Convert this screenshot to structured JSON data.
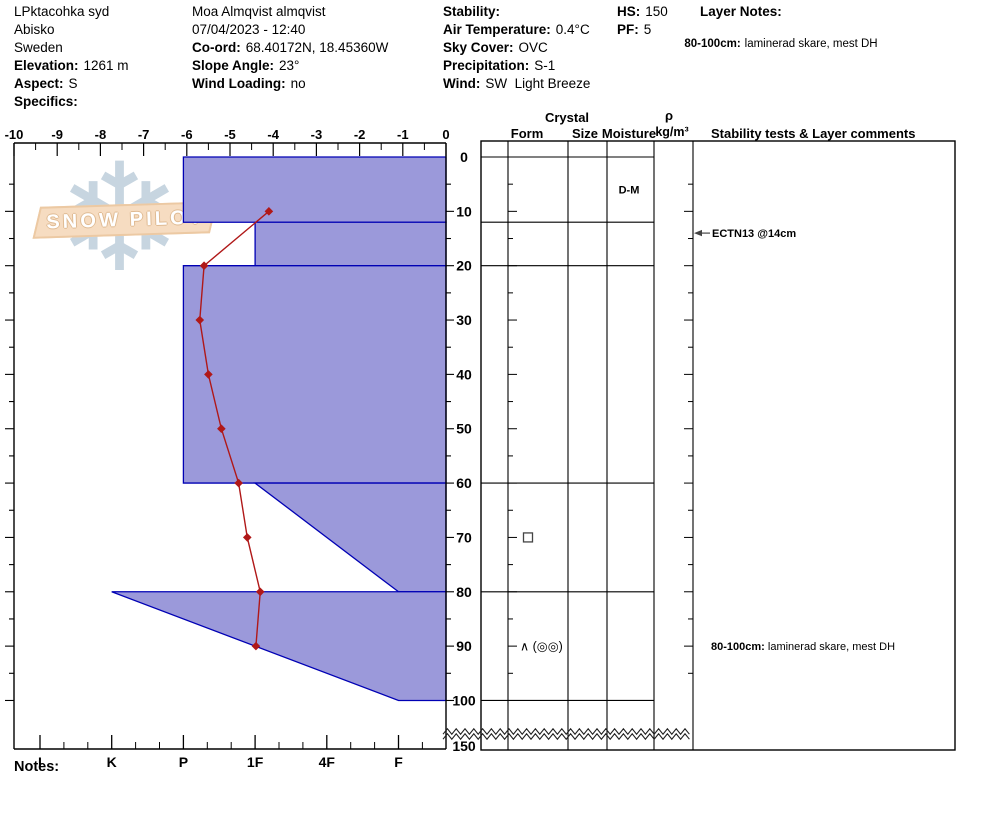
{
  "logo": {
    "text": "SNOW PILOT"
  },
  "notes_label": "Notes:",
  "header": {
    "location": {
      "name": "LPktacohka syd",
      "region": "Abisko",
      "country": "Sweden",
      "elevation_label": "Elevation:",
      "elevation": "1261 m",
      "aspect_label": "Aspect:",
      "aspect": "S",
      "specifics_label": "Specifics:"
    },
    "observer": {
      "name": "Moa Almqvist almqvist",
      "datetime": "07/04/2023 - 12:40",
      "coord_label": "Co-ord:",
      "coord": "68.40172N, 18.45360W",
      "slope_label": "Slope Angle:",
      "slope": "23°",
      "wind_loading_label": "Wind Loading:",
      "wind_loading": "no"
    },
    "conditions": {
      "stability_label": "Stability:",
      "air_temp_label": "Air Temperature:",
      "air_temp": "0.4°C",
      "sky_label": "Sky Cover:",
      "sky": "OVC",
      "precip_label": "Precipitation:",
      "precip": "S-1",
      "wind_label": "Wind:",
      "wind": "SW  Light Breeze"
    },
    "totals": {
      "hs_label": "HS:",
      "hs": "150",
      "pf_label": "PF:",
      "pf": "5"
    },
    "layer_notes": {
      "label": "Layer Notes:",
      "range": "80-100cm:",
      "text": "laminerad skare, mest DH"
    }
  },
  "panel": {
    "crystal_header": "Crystal",
    "form_header": "Form",
    "size_header": "Size",
    "moisture_header": "Moisture",
    "rho_header": "ρ",
    "rho_units": "kg/m³",
    "stability_header": "Stability tests & Layer comments"
  },
  "chart_data": {
    "type": "snow-profile",
    "depth_axis": {
      "unit": "cm",
      "labels": [
        0,
        10,
        20,
        30,
        40,
        50,
        60,
        70,
        80,
        90,
        100,
        150
      ],
      "pit_depth": 100,
      "total_height": 150,
      "break_after": 100
    },
    "temp_axis": {
      "unit": "°C",
      "min": -10,
      "max": 0,
      "tick_step": 1
    },
    "hardness_axis": {
      "categories": [
        "I",
        "K",
        "P",
        "1F",
        "4F",
        "F"
      ]
    },
    "layers": [
      {
        "top_cm": 0,
        "bottom_cm": 12,
        "hardness": "P",
        "moisture": "D-M"
      },
      {
        "top_cm": 12,
        "bottom_cm": 20,
        "hardness": "1F"
      },
      {
        "top_cm": 20,
        "bottom_cm": 60,
        "hardness": "P"
      },
      {
        "top_cm": 60,
        "bottom_cm": 80,
        "hardness_top": "1F",
        "hardness_bottom": "F",
        "grain_form": "FC",
        "grain_symbol": "□"
      },
      {
        "top_cm": 80,
        "bottom_cm": 100,
        "hardness_top": "K",
        "hardness_bottom": "F",
        "grain_form": "DH, MFcr",
        "grain_symbol": "∧ (◎◎)",
        "comment_bold": "80-100cm:",
        "comment": " laminerad skare, mest DH"
      }
    ],
    "temperature_profile": {
      "depths_cm": [
        10,
        20,
        30,
        40,
        50,
        60,
        70,
        80,
        90
      ],
      "temps_c": [
        -4.1,
        -5.6,
        -5.7,
        -5.5,
        -5.2,
        -4.8,
        -4.6,
        -4.3,
        -4.4
      ]
    },
    "stability_tests": [
      {
        "label": "ECTN13 @14cm",
        "depth_cm": 14
      }
    ],
    "colors": {
      "layer_fill": "#9b99da",
      "layer_stroke": "#0000b4",
      "temp_line": "#b01818",
      "axis": "#000000"
    }
  }
}
